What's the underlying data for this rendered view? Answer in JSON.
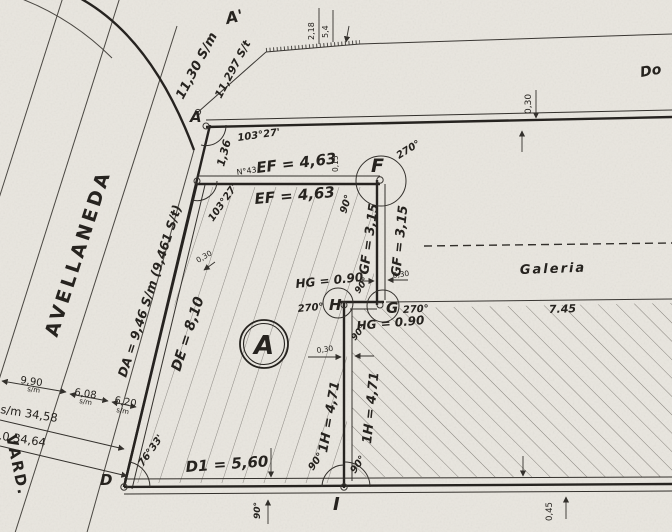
{
  "title": "Plano de mensura - parcela A",
  "streets": {
    "left_name": "AVELLANEDA",
    "bottom_name_partial": "VARD."
  },
  "neighbor": {
    "top_right_partial": "Do"
  },
  "points": {
    "a_prime": "A'",
    "a": "A",
    "d": "D",
    "f": "F",
    "g": "G",
    "h": "H",
    "i": "I"
  },
  "parcel": {
    "letter": "A"
  },
  "rooms": {
    "galeria": "Galeria",
    "galeria_width": "7.45"
  },
  "dimensions": {
    "front_sm": "11,30 S/m",
    "front_st": "11,297 S/t",
    "top_small_1": "2,18",
    "top_small_2": "5,4",
    "ae": "1,36",
    "house_no": "N°43",
    "ef": "EF = 4,63",
    "gf": "GF = 3,15",
    "hg": "HG = 0.90",
    "ih": "1H = 4,71",
    "di": "D1 = 5,60",
    "de": "DE = 8,10",
    "da": "DA = 9,46 S/m (9,461 S/t)",
    "wall_030": "0,30",
    "wall_015": "0,15",
    "wall_045": "0,45",
    "left_1": "9,90",
    "left_2": "6,08",
    "left_3": "6,20",
    "left_unit": "s/m",
    "left_total_sm": "s/m 34,58",
    "left_total_st": "s/t.0 34,64"
  },
  "angles": {
    "a": "103°27'",
    "e": "103°27'",
    "d": "76°33'",
    "right": "90°",
    "reflex": "270°"
  },
  "colors": {
    "paper": "#e9e6df",
    "ink": "#2e2b27",
    "hatch": "#6b6761"
  }
}
